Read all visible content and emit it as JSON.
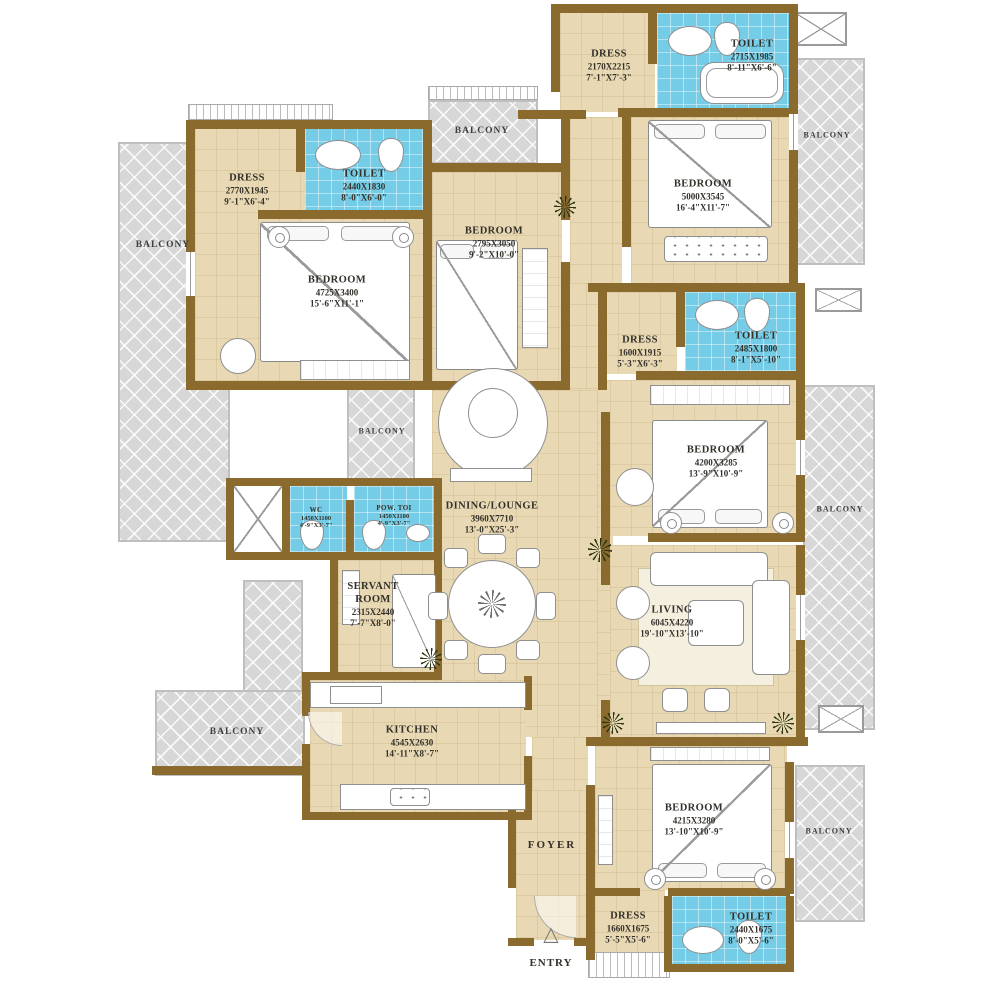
{
  "plan": {
    "balcony_label": "BALCONY",
    "foyer_label": "FOYER",
    "entry_label": "ENTRY"
  },
  "colors": {
    "wall": "#8a6b2d",
    "floor": "#e8d9b4",
    "toilet": "#74cce6",
    "balcony": "#d7d7d7",
    "fixture_line": "#8f8f8f"
  },
  "rooms": {
    "dress_tl": {
      "name": "DRESS",
      "mm": "2770X1945",
      "ft": "9'-1\"X6'-4\""
    },
    "toilet_tl": {
      "name": "TOILET",
      "mm": "2440X1830",
      "ft": "8'-0\"X6'-0\""
    },
    "bedroom_tl": {
      "name": "BEDROOM",
      "mm": "4725X3400",
      "ft": "15'-6\"X11'-1\""
    },
    "dress_tm": {
      "name": "DRESS",
      "mm": "2170X2215",
      "ft": "7'-1\"X7'-3\""
    },
    "bedroom_tm": {
      "name": "BEDROOM",
      "mm": "2795X3050",
      "ft": "9'-2\"X10'-0\""
    },
    "toilet_tr": {
      "name": "TOILET",
      "mm": "2715X1985",
      "ft": "8'-11\"X6'-6\""
    },
    "bedroom_tr": {
      "name": "BEDROOM",
      "mm": "5000X3545",
      "ft": "16'-4\"X11'-7\""
    },
    "dress_mr": {
      "name": "DRESS",
      "mm": "1600X1915",
      "ft": "5'-3\"X6'-3\""
    },
    "toilet_mr": {
      "name": "TOILET",
      "mm": "2485X1800",
      "ft": "8'-1\"X5'-10\""
    },
    "bedroom_mr": {
      "name": "BEDROOM",
      "mm": "4200X3285",
      "ft": "13'-9\"X10'-9\""
    },
    "living": {
      "name": "LIVING",
      "mm": "6045X4220",
      "ft": "19'-10\"X13'-10\""
    },
    "dining": {
      "name": "DINING/LOUNGE",
      "mm": "3960X7710",
      "ft": "13'-0\"X25'-3\""
    },
    "wc": {
      "name": "WC",
      "mm": "1450X1100",
      "ft": "4'-9\"X3'-7\""
    },
    "pow_toi": {
      "name": "POW. TOI",
      "mm": "1450X1100",
      "ft": "4'-9\"X3'-7\""
    },
    "servant": {
      "name": "SERVANT ROOM",
      "mm": "2315X2440",
      "ft": "7'-7\"X8'-0\""
    },
    "kitchen": {
      "name": "KITCHEN",
      "mm": "4545X2630",
      "ft": "14'-11\"X8'-7\""
    },
    "bedroom_br": {
      "name": "BEDROOM",
      "mm": "4215X3280",
      "ft": "13'-10\"X10'-9\""
    },
    "dress_b": {
      "name": "DRESS",
      "mm": "1660X1675",
      "ft": "5'-5\"X5'-6\""
    },
    "toilet_b": {
      "name": "TOILET",
      "mm": "2440X1675",
      "ft": "8'-0\"X5'-6\""
    }
  }
}
